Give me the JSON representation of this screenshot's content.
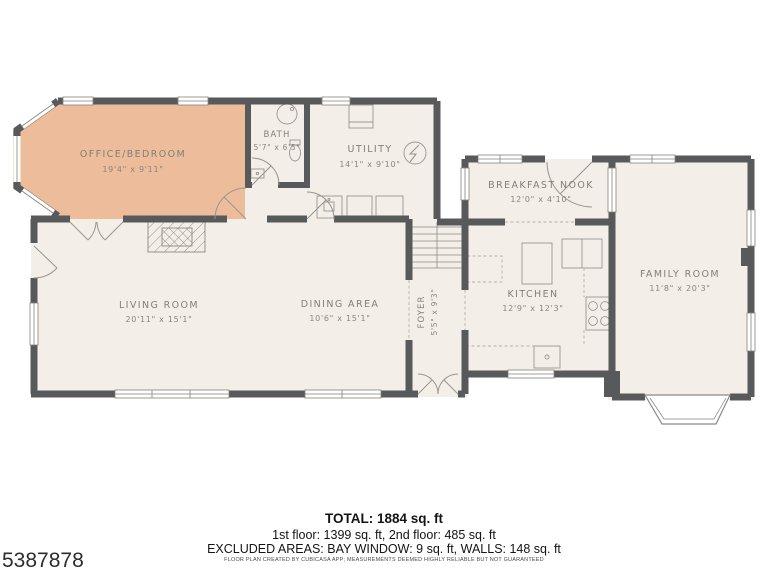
{
  "plan": {
    "rooms": {
      "office": {
        "label": "OFFICE/BEDROOM",
        "dims": "19'4\" x 9'11\""
      },
      "bath": {
        "label": "BATH",
        "dims": "5'7\" x 6'5\""
      },
      "utility": {
        "label": "UTILITY",
        "dims": "14'1\" x 9'10\""
      },
      "nook": {
        "label": "BREAKFAST NOOK",
        "dims": "12'0\" x 4'10\""
      },
      "family": {
        "label": "FAMILY ROOM",
        "dims": "11'8\" x 20'3\""
      },
      "living": {
        "label": "LIVING ROOM",
        "dims": "20'11\" x 15'1\""
      },
      "dining": {
        "label": "DINING AREA",
        "dims": "10'6\" x 15'1\""
      },
      "foyer": {
        "label": "FOYER",
        "dims": "5'5\" x 9'3\""
      },
      "kitchen": {
        "label": "KITCHEN",
        "dims": "12'9\" x 12'3\""
      }
    },
    "colors": {
      "highlight_room": "#ecbc9b",
      "bath_room": "#d1e1e3",
      "floor": "#f3eee8",
      "wall": "#58595a",
      "label_text": "#827f79"
    },
    "icons": {
      "electrical-panel": "circle-with-lightning-bolt",
      "shower": "circle-drain",
      "toilet": "oval-with-tank",
      "sink": "square-with-dot",
      "stove": "four-burner-grid",
      "fireplace": "hatched-rectangle",
      "stairs": "tread-lines"
    }
  },
  "footer": {
    "total": "TOTAL: 1884 sq. ft",
    "floors": "1st floor: 1399 sq. ft, 2nd floor: 485 sq. ft",
    "excluded": "EXCLUDED AREAS: BAY WINDOW: 9 sq. ft, WALLS: 148 sq. ft",
    "disclaimer": "FLOOR PLAN CREATED BY CUBICASA APP; MEASUREMENTS DEEMED HIGHLY RELIABLE BUT NOT GUARANTEED",
    "listing_id": "5387878"
  }
}
